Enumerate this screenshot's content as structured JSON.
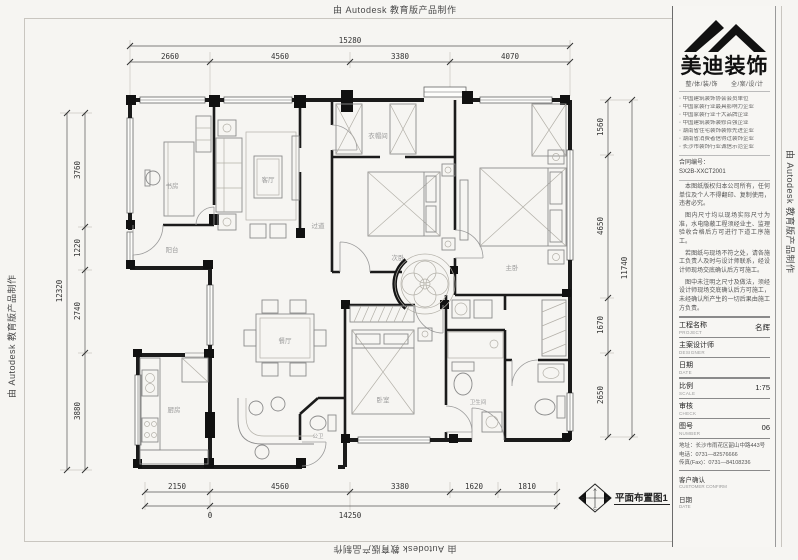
{
  "watermark": {
    "text": "由 Autodesk 教育版产品制作"
  },
  "plan": {
    "caption": "平面布置图1",
    "compass": {
      "letters": [
        "A",
        "B",
        "C",
        "D"
      ]
    },
    "rooms": [
      {
        "label": "书房"
      },
      {
        "label": "客厅"
      },
      {
        "label": "阳台"
      },
      {
        "label": "衣帽间"
      },
      {
        "label": "次卧"
      },
      {
        "label": "主卧"
      },
      {
        "label": "过道"
      },
      {
        "label": "餐厅"
      },
      {
        "label": "厨房"
      },
      {
        "label": "卧室"
      },
      {
        "label": "卫生间"
      },
      {
        "label": "公卫"
      }
    ],
    "dims": {
      "top_total": "15280",
      "top": [
        "2660",
        "4560",
        "3380",
        "4070"
      ],
      "bottom": [
        "2150",
        "4560",
        "3380",
        "1620",
        "1810"
      ],
      "bottom_total": "14250",
      "bottom_origin": "0",
      "left_total": "12320",
      "left": [
        "3760",
        "1220",
        "2740",
        "3880"
      ],
      "right_total": "11740",
      "right": [
        "1560",
        "4650",
        "1670",
        "2650"
      ]
    }
  },
  "title_block": {
    "brand": {
      "name": "美迪装饰",
      "slogan": "整/体/装/饰　　全/案/设/计"
    },
    "credentials": [
      "中国建筑装饰协会会员单位",
      "中国家装行业最具影响力企业",
      "中国家装行业十大品牌企业",
      "中国建筑装饰装修百强企业",
      "湖南省住宅装饰装修先进企业",
      "湖南省消费者信得过装饰企业",
      "长沙市装饰行业诚信示范企业"
    ],
    "contract": {
      "label": "合同编号：",
      "number": "SX2B-XXCT2001"
    },
    "notes": [
      "本图纸版权归本公司所有，任何单位及个人不得翻印、复制使用，违者必究。",
      "图内尺寸均以现场实际尺寸为准，水电隐蔽工程须经业主、监理验收合格后方可进行下道工序施工。",
      "若图纸与现场不符之处，请各施工负责人及时与设计师联系，经设计师现场交底确认后方可施工。",
      "图中未注明之尺寸及做法，须经设计师现场交底确认后方可施工，未经确认所产生的一切后果由施工方负责。"
    ],
    "fields": [
      {
        "cn": "工程名称",
        "en": "PROJECT",
        "value": "名辉"
      },
      {
        "cn": "主案设计师",
        "en": "DESIGNER",
        "value": ""
      },
      {
        "cn": "日期",
        "en": "DATE",
        "value": ""
      },
      {
        "cn": "比例",
        "en": "SCALE",
        "value": "1:75"
      },
      {
        "cn": "审核",
        "en": "CHECK",
        "value": ""
      },
      {
        "cn": "图号",
        "en": "NUMBER",
        "value": "06"
      }
    ],
    "address_lines": [
      "地址：长沙市雨花区韶山中路443号",
      "电话：0731—82576666",
      "传真(Fax)：0731—84108236"
    ],
    "customer": {
      "cn": "客户确认",
      "en": "CUSTOMER CONFIRM",
      "date_cn": "日期",
      "date_en": "DATE"
    }
  }
}
